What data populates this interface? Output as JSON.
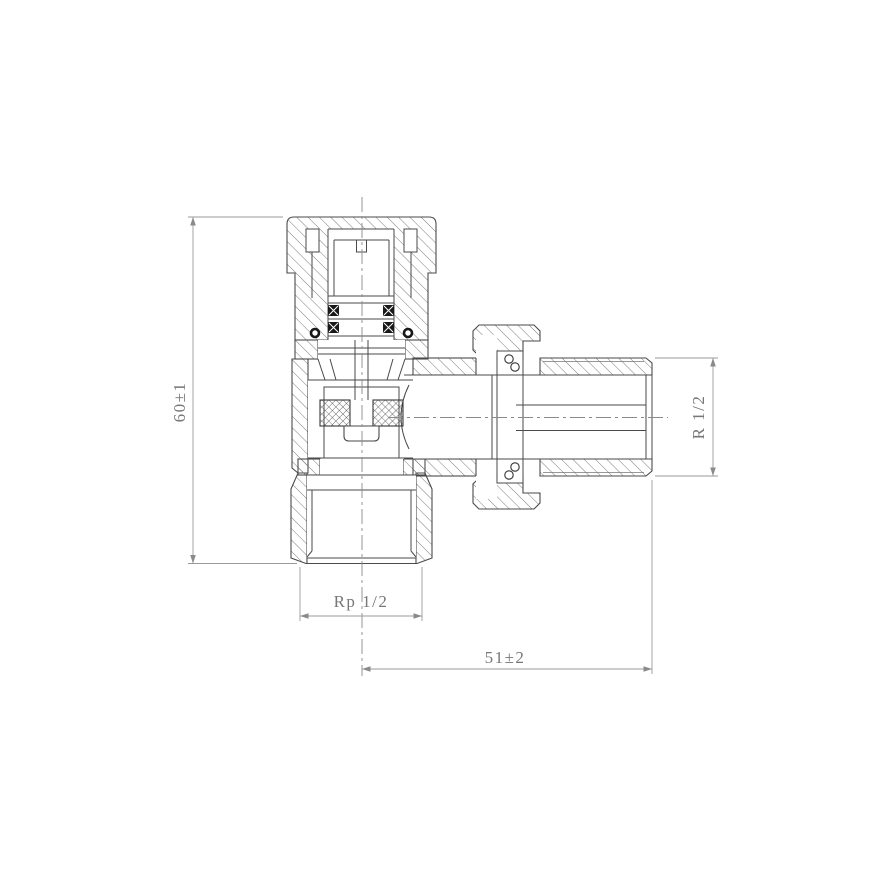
{
  "drawing": {
    "colors": {
      "background": "#ffffff",
      "outline": "#4a4a4a",
      "hatch": "#6f6f6f",
      "dimension_line": "#9a9a9a",
      "dimension_text": "#777777",
      "oring_fill": "#181818"
    },
    "dimensions": {
      "overall_height": {
        "label": "60±1"
      },
      "outlet_thread": {
        "label": "R 1/2"
      },
      "inlet_thread": {
        "label": "Rp 1/2"
      },
      "outlet_length": {
        "label": "51±2"
      }
    }
  }
}
